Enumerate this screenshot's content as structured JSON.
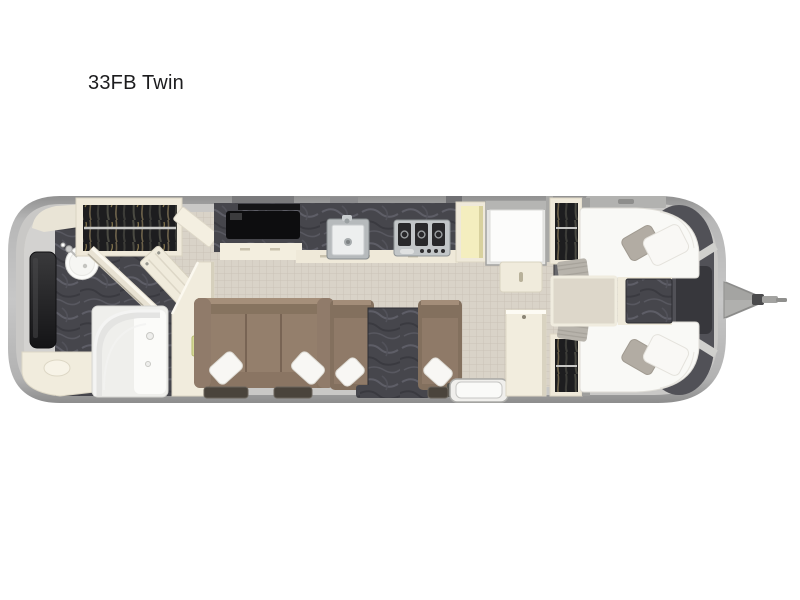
{
  "page": {
    "title": "33FB Twin",
    "background_color": "#ffffff",
    "title_color": "#1c1c1e"
  },
  "floorplan": {
    "label": "33FB Twin",
    "type": "travel-trailer-floorplan",
    "hitch_side": "right",
    "palette": {
      "shell_outer_gray": "#9e9e9e",
      "shell_inner_gray": "#c9c8c6",
      "floor_main_beige": "#d9d3c8",
      "floor_rear_gray": "#d3d2d0",
      "carpet_counter_dark": "#46464c",
      "cabinet_cream": "#f1ecdd",
      "sofa_brown": "#8d7866",
      "bed_white": "#fafaf7",
      "pillow_gray": "#b2aca3",
      "clothes_dark": "#1d1d1f",
      "pantry_yellow": "#f4eebf",
      "stainless": "#c2c6c8",
      "tv_black": "#0d0d0f",
      "handle_green": "#d6da96"
    },
    "areas": [
      {
        "name": "rear-bathroom",
        "features": [
          "hanging-wardrobe",
          "round-sink",
          "curved-glass-shower",
          "vanity-counter",
          "wall-tv",
          "open-bath-door",
          "angled-cabinet"
        ]
      },
      {
        "name": "galley-kitchen",
        "features": [
          "media-console-tv",
          "kitchen-sink",
          "three-burner-cooktop",
          "pantry-cabinet",
          "refrigerator",
          "base-cabinet"
        ]
      },
      {
        "name": "living-area",
        "features": [
          "three-seat-sofa",
          "dinette-bench-left",
          "dinette-table",
          "dinette-bench-right",
          "throw-pillows",
          "entry-step",
          "floor-windows"
        ]
      },
      {
        "name": "front-twin-bedroom",
        "features": [
          "twin-bed-top",
          "twin-bed-bottom",
          "nightstand",
          "hanging-wardrobe-top",
          "hanging-wardrobe-bottom",
          "center-carpet-runner",
          "front-storage-band"
        ]
      }
    ],
    "hitch": {
      "name": "tow-hitch",
      "parts": [
        "a-frame-struts",
        "hitch-triangle",
        "coupler",
        "jack-bar"
      ]
    }
  }
}
